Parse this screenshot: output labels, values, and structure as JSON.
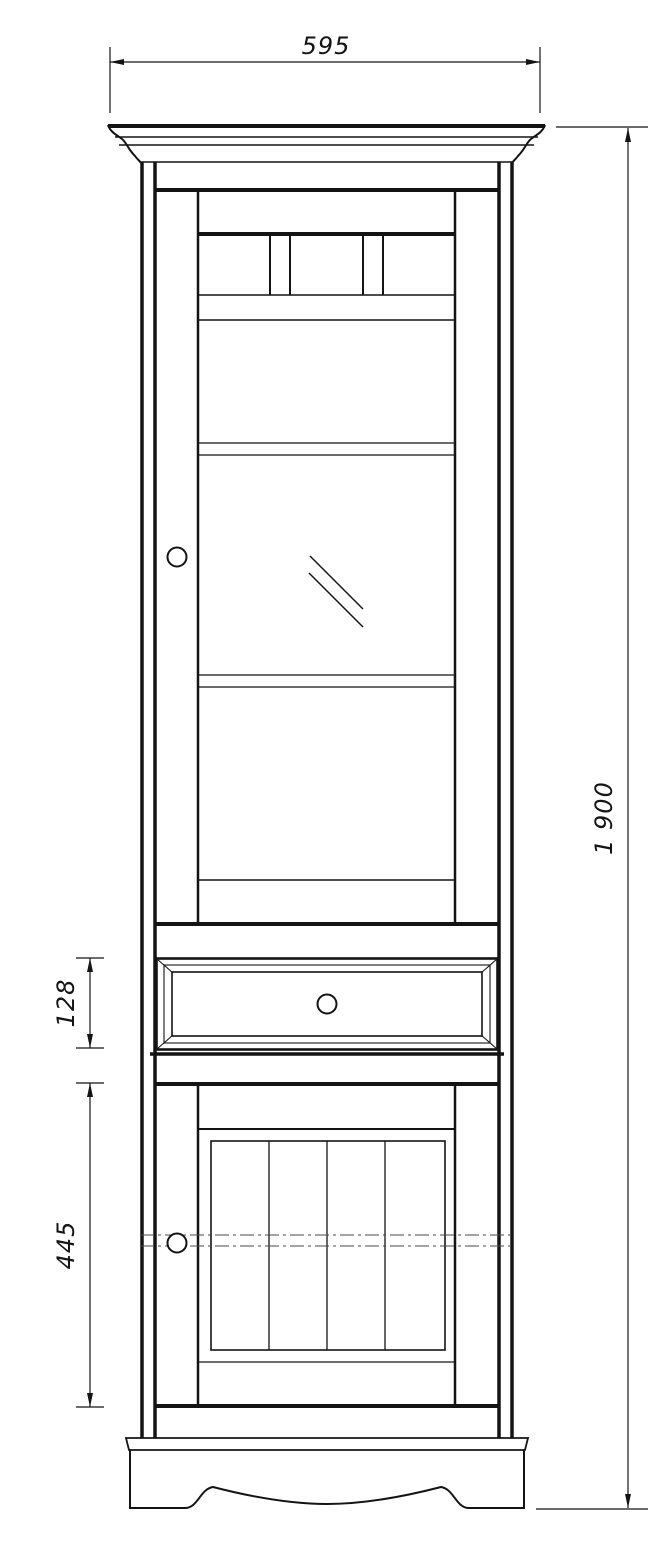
{
  "drawing": {
    "description": "Technical front-view drawing of a tall cabinet with glass display door, single drawer and lower plank-panel door",
    "line_color": "#141414",
    "background_color": "#ffffff",
    "dimensions": {
      "overall_width": "595",
      "overall_height": "1 900",
      "drawer_height": "128",
      "lower_door_height": "445"
    }
  }
}
